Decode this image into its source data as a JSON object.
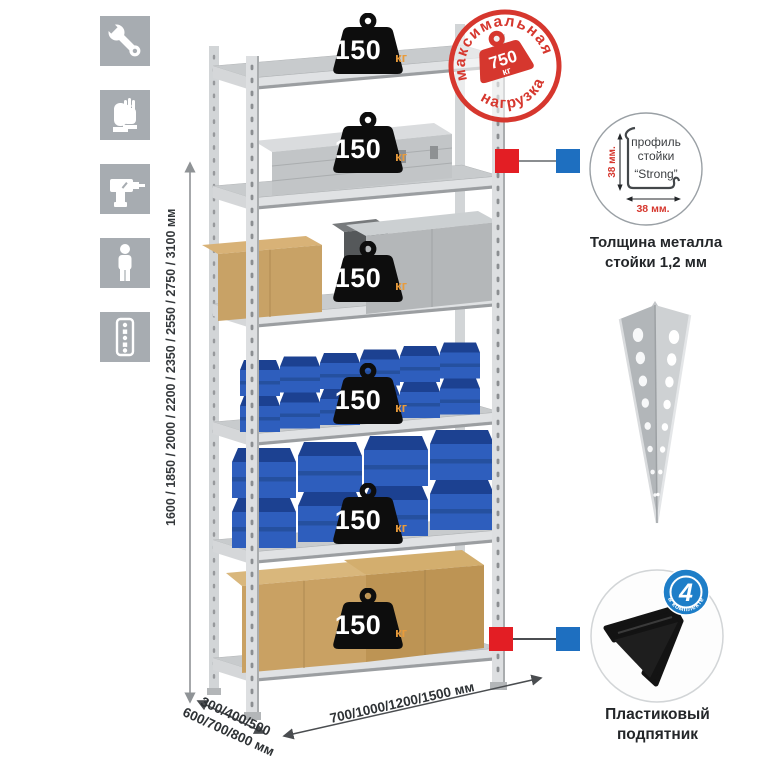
{
  "stamp": {
    "arc_top": "максимальная",
    "arc_bottom": "нагрузка",
    "value": "750",
    "unit": "кг"
  },
  "weights": [
    {
      "value": "150",
      "unit": "кг"
    },
    {
      "value": "150",
      "unit": "кг"
    },
    {
      "value": "150",
      "unit": "кг"
    },
    {
      "value": "150",
      "unit": "кг"
    },
    {
      "value": "150",
      "unit": "кг"
    },
    {
      "value": "150",
      "unit": "кг"
    }
  ],
  "dimensions": {
    "height": "1600 / 1850 / 2000 / 2200 / 2350 / 2550 / 2750 / 3100 мм",
    "depth_line1": "300/400/500",
    "depth_line2": "600/700/800 мм",
    "width": "700/1000/1200/1500 мм"
  },
  "profile_callout": {
    "label_line1": "профиль",
    "label_line2": "стойки",
    "label_line3": "“Strong”",
    "dim_vertical": "38 мм.",
    "dim_horizontal": "38 мм.",
    "caption_line1": "Толщина металла",
    "caption_line2": "стойки 1,2 мм"
  },
  "foot_callout": {
    "badge_value": "4",
    "badge_arc": "в комплекте",
    "caption_line1": "Пластиковый",
    "caption_line2": "подпятник"
  },
  "left_icons": {
    "items": [
      {
        "name": "wrench"
      },
      {
        "name": "gloves"
      },
      {
        "name": "drill"
      },
      {
        "name": "person"
      },
      {
        "name": "perforated-post"
      }
    ]
  },
  "colors": {
    "stamp_red": "#d6372e",
    "marker_red": "#e31e24",
    "marker_blue": "#1e6fc0",
    "bin_blue": "#2e5ebd",
    "weight_black": "#0d0d0d",
    "unit_orange": "#e89b3c",
    "tile_gray": "#a7acb1"
  }
}
